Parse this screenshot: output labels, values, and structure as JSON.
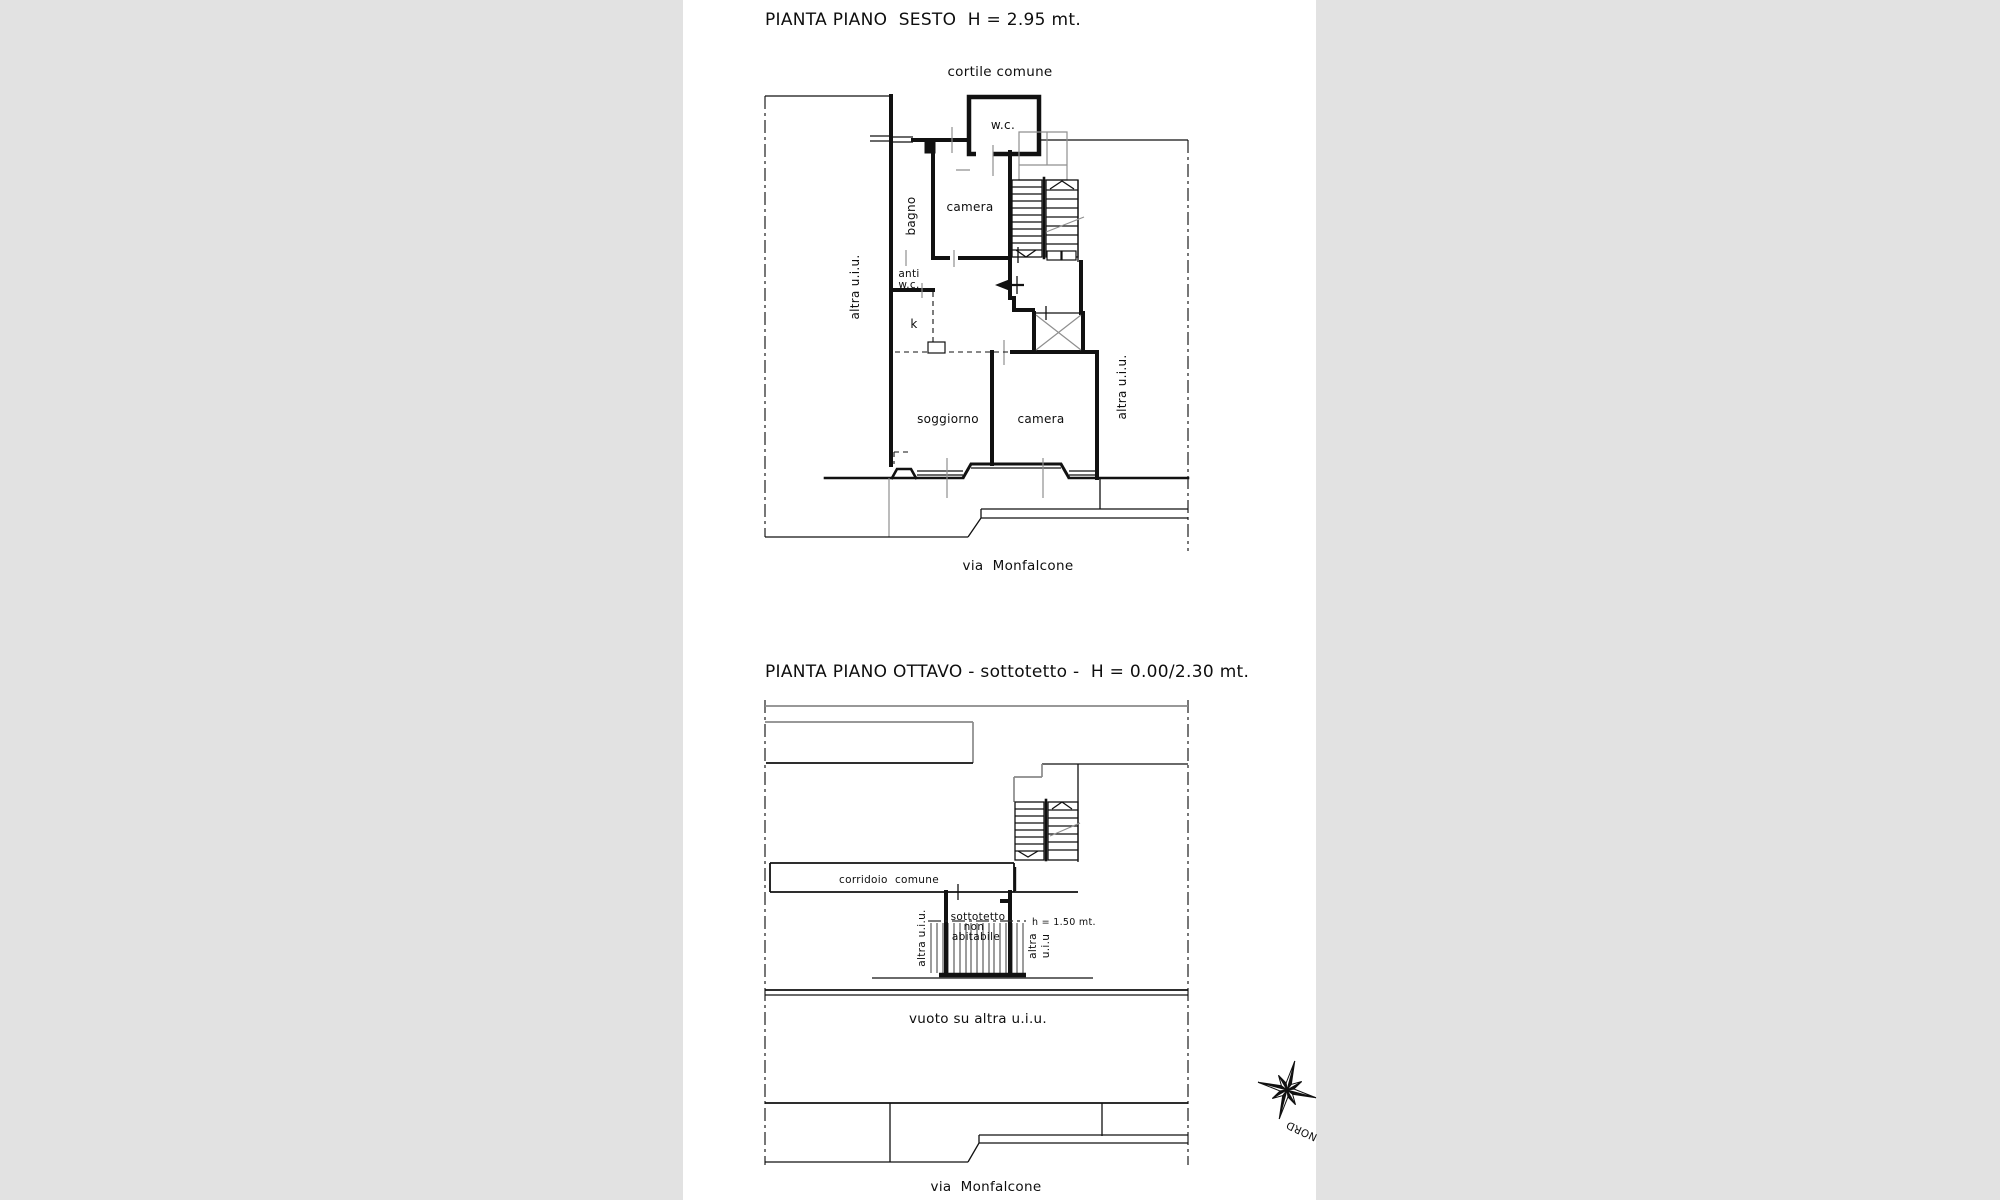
{
  "document": {
    "background_color": "#e2e2e2",
    "page_color": "#ffffff",
    "line_color": "#111111"
  },
  "plan_sesto": {
    "title": "PIANTA PIANO  SESTO  H = 2.95 mt.",
    "labels": {
      "cortile": "cortile comune",
      "wc": "w.c.",
      "bagno": "bagno",
      "camera_top": "camera",
      "anti_wc_line1": "anti",
      "anti_wc_line2": "w.c.",
      "k": "k",
      "soggiorno": "soggiorno",
      "camera_bottom": "camera",
      "altra_uiu_left": "altra u.i.u.",
      "altra_uiu_right": "altra u.i.u.",
      "via": "via  Monfalcone"
    }
  },
  "plan_ottavo": {
    "title": "PIANTA PIANO OTTAVO - sottotetto -  H = 0.00/2.30 mt.",
    "labels": {
      "corridoio": "corridoio  comune",
      "sottotetto_line1": "sottotetto",
      "sottotetto_line2": "non",
      "sottotetto_line3": "abitabile",
      "height_note": "h = 1.50 mt.",
      "altra_uiu_left": "altra u.i.u.",
      "altra_right_line1": "altra",
      "altra_right_line2": "u.i.u",
      "vuoto": "vuoto su altra u.i.u.",
      "via": "via  Monfalcone"
    }
  },
  "compass": {
    "north_label": "NORD"
  }
}
